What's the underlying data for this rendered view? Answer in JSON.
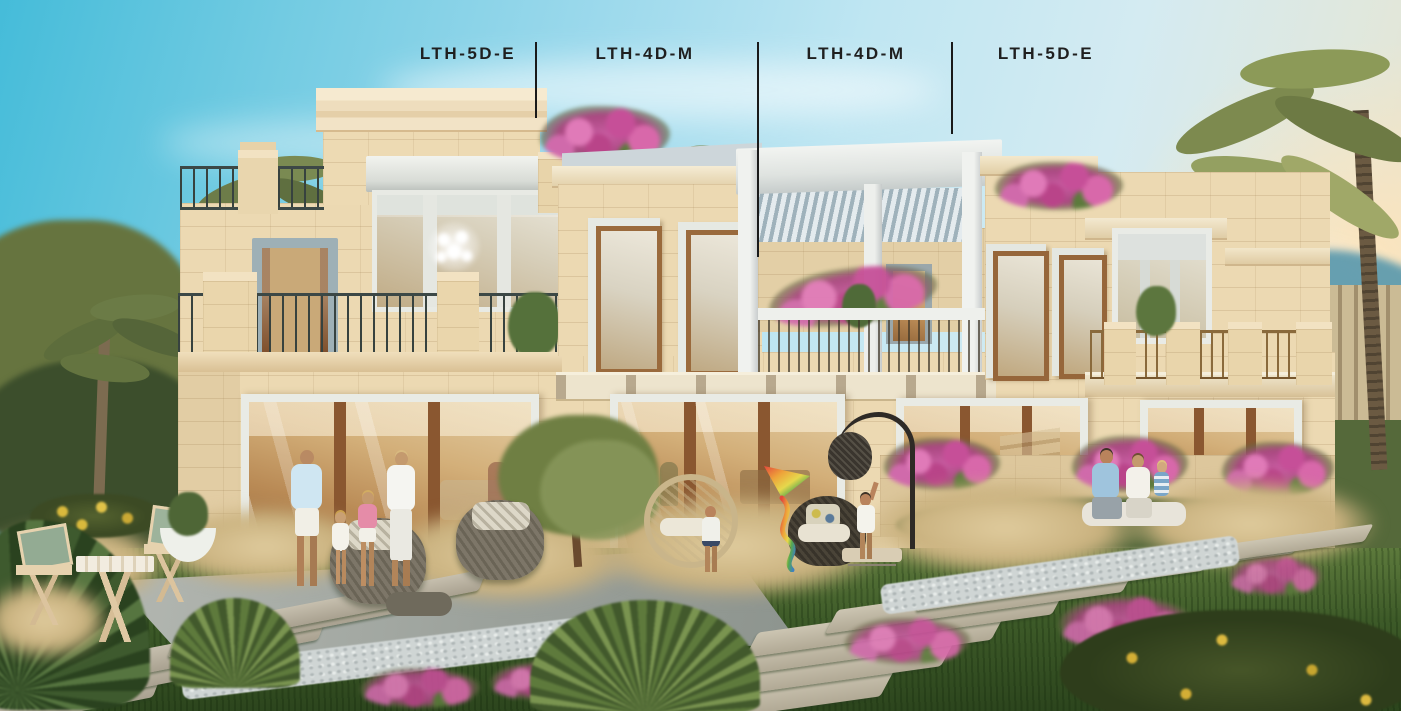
{
  "annotations": {
    "unit_labels": [
      "LTH-5D-E",
      "LTH-4D-M",
      "LTH-4D-M",
      "LTH-5D-E"
    ]
  },
  "palette": {
    "label_text": "#1f1f1f",
    "divider_line": "#1a1a1a",
    "sky_top": "#45bcd9",
    "sky_light": "#d4ebf2",
    "sunset_glow": "#f2dcba",
    "facade_stone": "#ecd9b2",
    "facade_shadow": "#d8c094",
    "white_trim": "#eef0ec",
    "wood_frame": "#8a5730",
    "railing_dark": "#37423f",
    "railing_gold": "#8a6a3c",
    "bougainvillea_pink": "#cc5a9f",
    "grass_green": "#3f5a2c",
    "paver_gray": "#c0b9a6"
  }
}
